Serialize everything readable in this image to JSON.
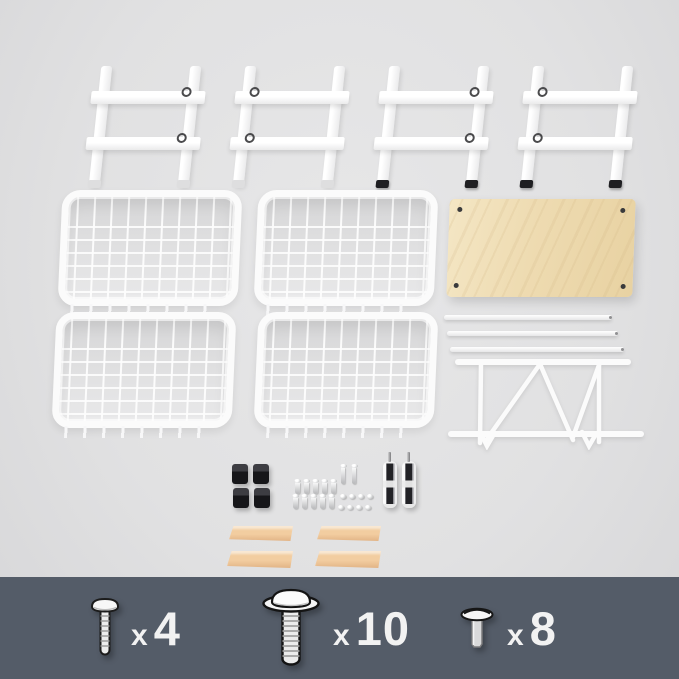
{
  "colors": {
    "background": "#e0e0e1",
    "banner_background": "#545c68",
    "banner_text": "#f2f2f2",
    "wood_shelf": "#eedbb1",
    "wood_strip": "#eac499",
    "white_parts": "#fafafa",
    "black_parts": "#1e1e20"
  },
  "banner": {
    "items": [
      {
        "icon": "pan-head-screw-icon",
        "times": "x",
        "count": "4",
        "label": "x 4"
      },
      {
        "icon": "flange-head-screw-icon",
        "times": "x",
        "count": "10",
        "label": "x 10"
      },
      {
        "icon": "truss-head-screw-icon",
        "times": "x",
        "count": "8",
        "label": "x 8"
      }
    ]
  },
  "parts": [
    {
      "name": "ladder-side-frame",
      "qty": 4
    },
    {
      "name": "wire-basket",
      "qty": 4
    },
    {
      "name": "wood-top-shelf",
      "qty": 1
    },
    {
      "name": "support-rod",
      "qty": 3
    },
    {
      "name": "wire-shelf-bracket",
      "qty": 1
    },
    {
      "name": "black-foot-cap",
      "qty": 4
    },
    {
      "name": "small-screw-pin",
      "qty": 10
    },
    {
      "name": "long-screw-pin",
      "qty": 2
    },
    {
      "name": "dome-screw",
      "qty": 8
    },
    {
      "name": "metal-clamp",
      "qty": 2
    },
    {
      "name": "wood-handle-strip",
      "qty": 4
    }
  ]
}
